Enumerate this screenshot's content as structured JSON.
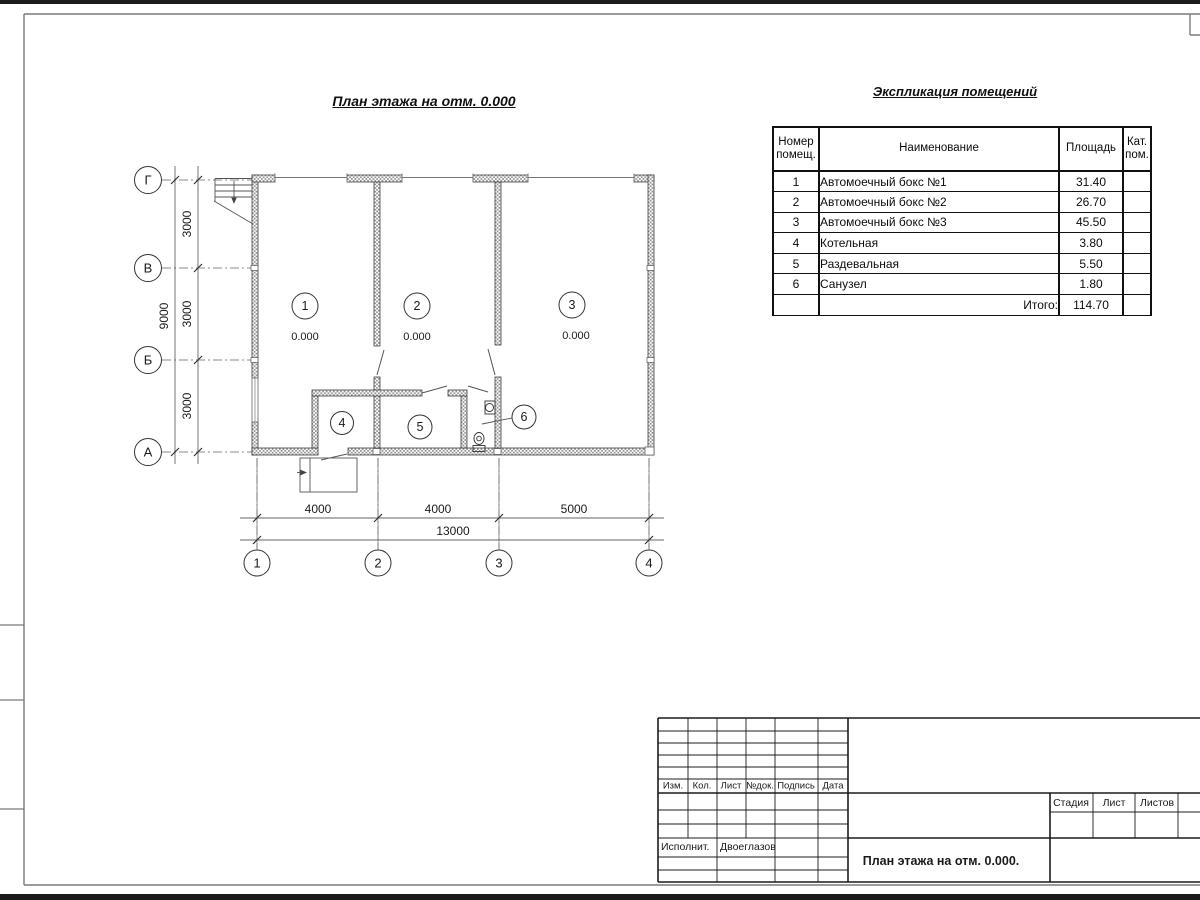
{
  "colors": {
    "paper": "#ffffff",
    "ink": "#1a1a1a",
    "thin_line": "#707070",
    "wall_hatch": "#8f8f8f",
    "frame": "#7a7a7a"
  },
  "plan": {
    "title": "План этажа на отм. 0.000",
    "axes_vertical": [
      "Г",
      "В",
      "Б",
      "А"
    ],
    "axes_horizontal": [
      "1",
      "2",
      "3",
      "4"
    ],
    "dims_left_segments": [
      "3000",
      "3000",
      "3000"
    ],
    "dims_left_total": "9000",
    "dims_bottom_segments": [
      "4000",
      "4000",
      "5000"
    ],
    "dims_bottom_total": "13000",
    "rooms": [
      {
        "num": "1",
        "elevation": "0.000"
      },
      {
        "num": "2",
        "elevation": "0.000"
      },
      {
        "num": "3",
        "elevation": "0.000"
      },
      {
        "num": "4"
      },
      {
        "num": "5"
      },
      {
        "num": "6"
      }
    ]
  },
  "spec": {
    "title": "Экспликация помещений",
    "headers": {
      "num": "Номер помещ.",
      "name": "Наименование",
      "area": "Площадь",
      "cat": "Кат. пом."
    },
    "rows": [
      {
        "num": "1",
        "name": "Автомоечный бокс №1",
        "area": "31.40"
      },
      {
        "num": "2",
        "name": "Автомоечный бокс №2",
        "area": "26.70"
      },
      {
        "num": "3",
        "name": "Автомоечный бокс №3",
        "area": "45.50"
      },
      {
        "num": "4",
        "name": "Котельная",
        "area": "3.80"
      },
      {
        "num": "5",
        "name": "Раздевальная",
        "area": "5.50"
      },
      {
        "num": "6",
        "name": "Санузел",
        "area": "1.80"
      }
    ],
    "total_label": "Итого:",
    "total_value": "114.70"
  },
  "titleblock": {
    "cols": [
      "Изм.",
      "Кол.",
      "Лист",
      "№док.",
      "Подпись",
      "Дата"
    ],
    "executor_label": "Исполнит.",
    "executor_name": "Двоеглазов",
    "doc_title": "План этажа на отм. 0.000.",
    "stage_label": "Стадия",
    "sheet_label": "Лист",
    "sheets_label": "Листов"
  }
}
